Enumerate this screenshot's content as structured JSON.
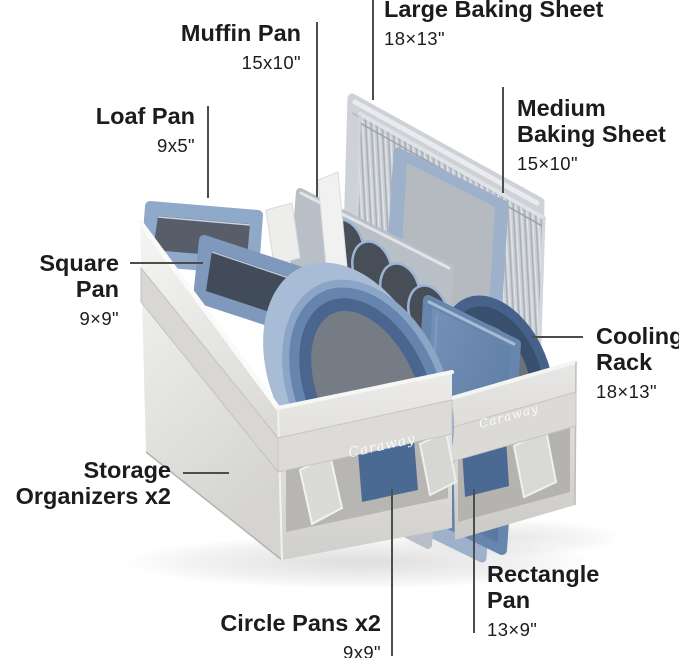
{
  "scene": {
    "background": "#ffffff",
    "text_color": "#1c1c1e",
    "callout_line_color": "#4d4d4d",
    "pan_blue": "#6585ae",
    "organizer_fabric_gray": "#dcdbd8"
  },
  "product": {
    "brand": "Caraway",
    "strap_logo_left": "Caraway",
    "strap_logo_right": "Caraway"
  },
  "callouts": {
    "large_baking_sheet": {
      "title": "Large Baking Sheet",
      "dims": "18×13\""
    },
    "muffin_pan": {
      "title": "Muffin Pan",
      "dims": "15x10\""
    },
    "loaf_pan": {
      "title": "Loaf Pan",
      "dims": "9x5\""
    },
    "medium_baking_sheet": {
      "title": "Medium\nBaking Sheet",
      "dims": "15×10\""
    },
    "square_pan": {
      "title": "Square Pan",
      "dims": "9×9\""
    },
    "cooling_rack": {
      "title": "Cooling\nRack",
      "dims": "18×13\""
    },
    "storage_organizers": {
      "title": "Storage\nOrganizers x2"
    },
    "circle_pans": {
      "title": "Circle Pans x2",
      "dims": "9x9\""
    },
    "rectangle_pan": {
      "title": "Rectangle\nPan",
      "dims": "13×9\""
    }
  }
}
